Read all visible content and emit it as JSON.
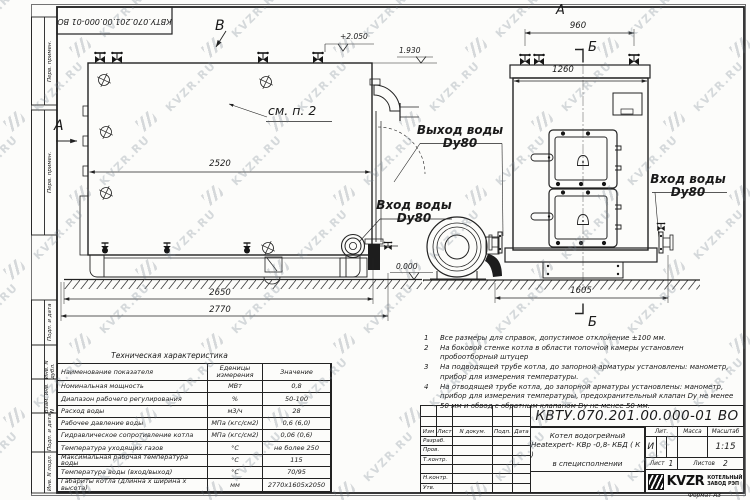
{
  "watermark": {
    "text": "KVZR.RU"
  },
  "doc": {
    "number": "КВТУ.070.201.00.000-01 ВО",
    "format_label": "Формат  А3"
  },
  "margin_stamps": {
    "perv1": "Перв. примен.",
    "perv2": "Перв. примен.",
    "podp1": "Подп. и дата",
    "inv_dubl": "Инв. N дубл.",
    "vzam": "Взам. инв. N",
    "podp2": "Подп. и дата",
    "inv_podl": "Инв. N подл."
  },
  "side_view": {
    "view_label": "В",
    "section_label": "А",
    "note_ref": "см. п. 2",
    "dim_shell": "2520",
    "dim_base": "2650",
    "dim_overall": "2770",
    "elev_top": "+2.050",
    "elev_shell": "1.930",
    "elev_zero": "0.000",
    "inlet": {
      "line1": "Вход воды",
      "line2": "Dy80"
    }
  },
  "front_view": {
    "view_label": "А",
    "section_label_top": "Б",
    "section_label_bottom": "Б",
    "dim_valves": "960",
    "dim_top": "1260",
    "dim_base": "1605",
    "outlet": {
      "line1": "Выход воды",
      "line2": "Dy80"
    },
    "inlet": {
      "line1": "Вход воды",
      "line2": "Dy80"
    }
  },
  "notes": {
    "items": [
      {
        "num": "1",
        "text": "Все размеры для справок, допустимое отклонение ±100 мм."
      },
      {
        "num": "2",
        "text": "На боковой стенке котла в области топочной камеры установлен пробоотборный штуцер"
      },
      {
        "num": "3",
        "text": "На  подводящей трубе котла, до запорной арматуры установлены: манометр, прибор для измерения температуры."
      },
      {
        "num": "4",
        "text": "На отводящей трубе котла, до запорной арматуры установлены: манометр, прибор для измерения температуры, предохранительный клапан Dу не менее 50 мм и обвод с обратным клапаном Dу не менее 50 мм."
      }
    ]
  },
  "tech_table": {
    "title": "Техническая характеристика",
    "headers": {
      "name": "Наименование показателя",
      "units": "Еденицы измерения",
      "value": "Значение"
    },
    "rows": [
      {
        "name": "Номинальная мощность",
        "units": "МВт",
        "value": "0,8"
      },
      {
        "name": "Диапазон рабочего регулирования",
        "units": "%",
        "value": "50-100"
      },
      {
        "name": "Расход воды",
        "units": "м3/ч",
        "value": "28"
      },
      {
        "name": "Рабочее давление воды",
        "units": "МПа (кгс/см2)",
        "value": "0,6 (6,0)"
      },
      {
        "name": "Гидравлическое сопротивление котла",
        "units": "МПа (кгс/см2)",
        "value": "0,06 (0,6)"
      },
      {
        "name": "Температура уходящих газов",
        "units": "°С",
        "value": "не более 250"
      },
      {
        "name": "Максимальная рабочая температура воды",
        "units": "°С",
        "value": "115"
      },
      {
        "name": "Температура воды (вход/выход)",
        "units": "°С",
        "value": "70/95"
      },
      {
        "name": "Габариты котла (длинна х ширина х высота)",
        "units": "мм",
        "value": "2770х1605х2050"
      }
    ]
  },
  "title_block": {
    "doc_number": "КВТУ.070.201.00.000-01 ВО",
    "columns": {
      "izm": "Изм",
      "list": "Лист",
      "doc": "N докум.",
      "podp": "Подп.",
      "date": "Дата"
    },
    "row_labels": {
      "razrab": "Разраб.",
      "prov": "Пров.",
      "tkontr": "Т.контр.",
      "nkontr": "Н.контр.",
      "utv": "Утв."
    },
    "product": {
      "line1": "Котел водогрейный",
      "line2": "Heatexpert- КВр -0,8- КБД ( К )",
      "line3": "в специсполнении"
    },
    "lit": {
      "label": "Лит.",
      "value": "И"
    },
    "mass": {
      "label": "Масса"
    },
    "scale": {
      "label": "Масштаб",
      "value": "1:15"
    },
    "sheets": {
      "sheet_label": "Лист",
      "sheet_value": "1",
      "total_label": "Листов",
      "total_value": "2"
    },
    "org": {
      "logo": "KVZR",
      "name_line1": "КОТЕЛЬНЫЙ",
      "name_line2": "ЗАВОД РЭП"
    }
  }
}
